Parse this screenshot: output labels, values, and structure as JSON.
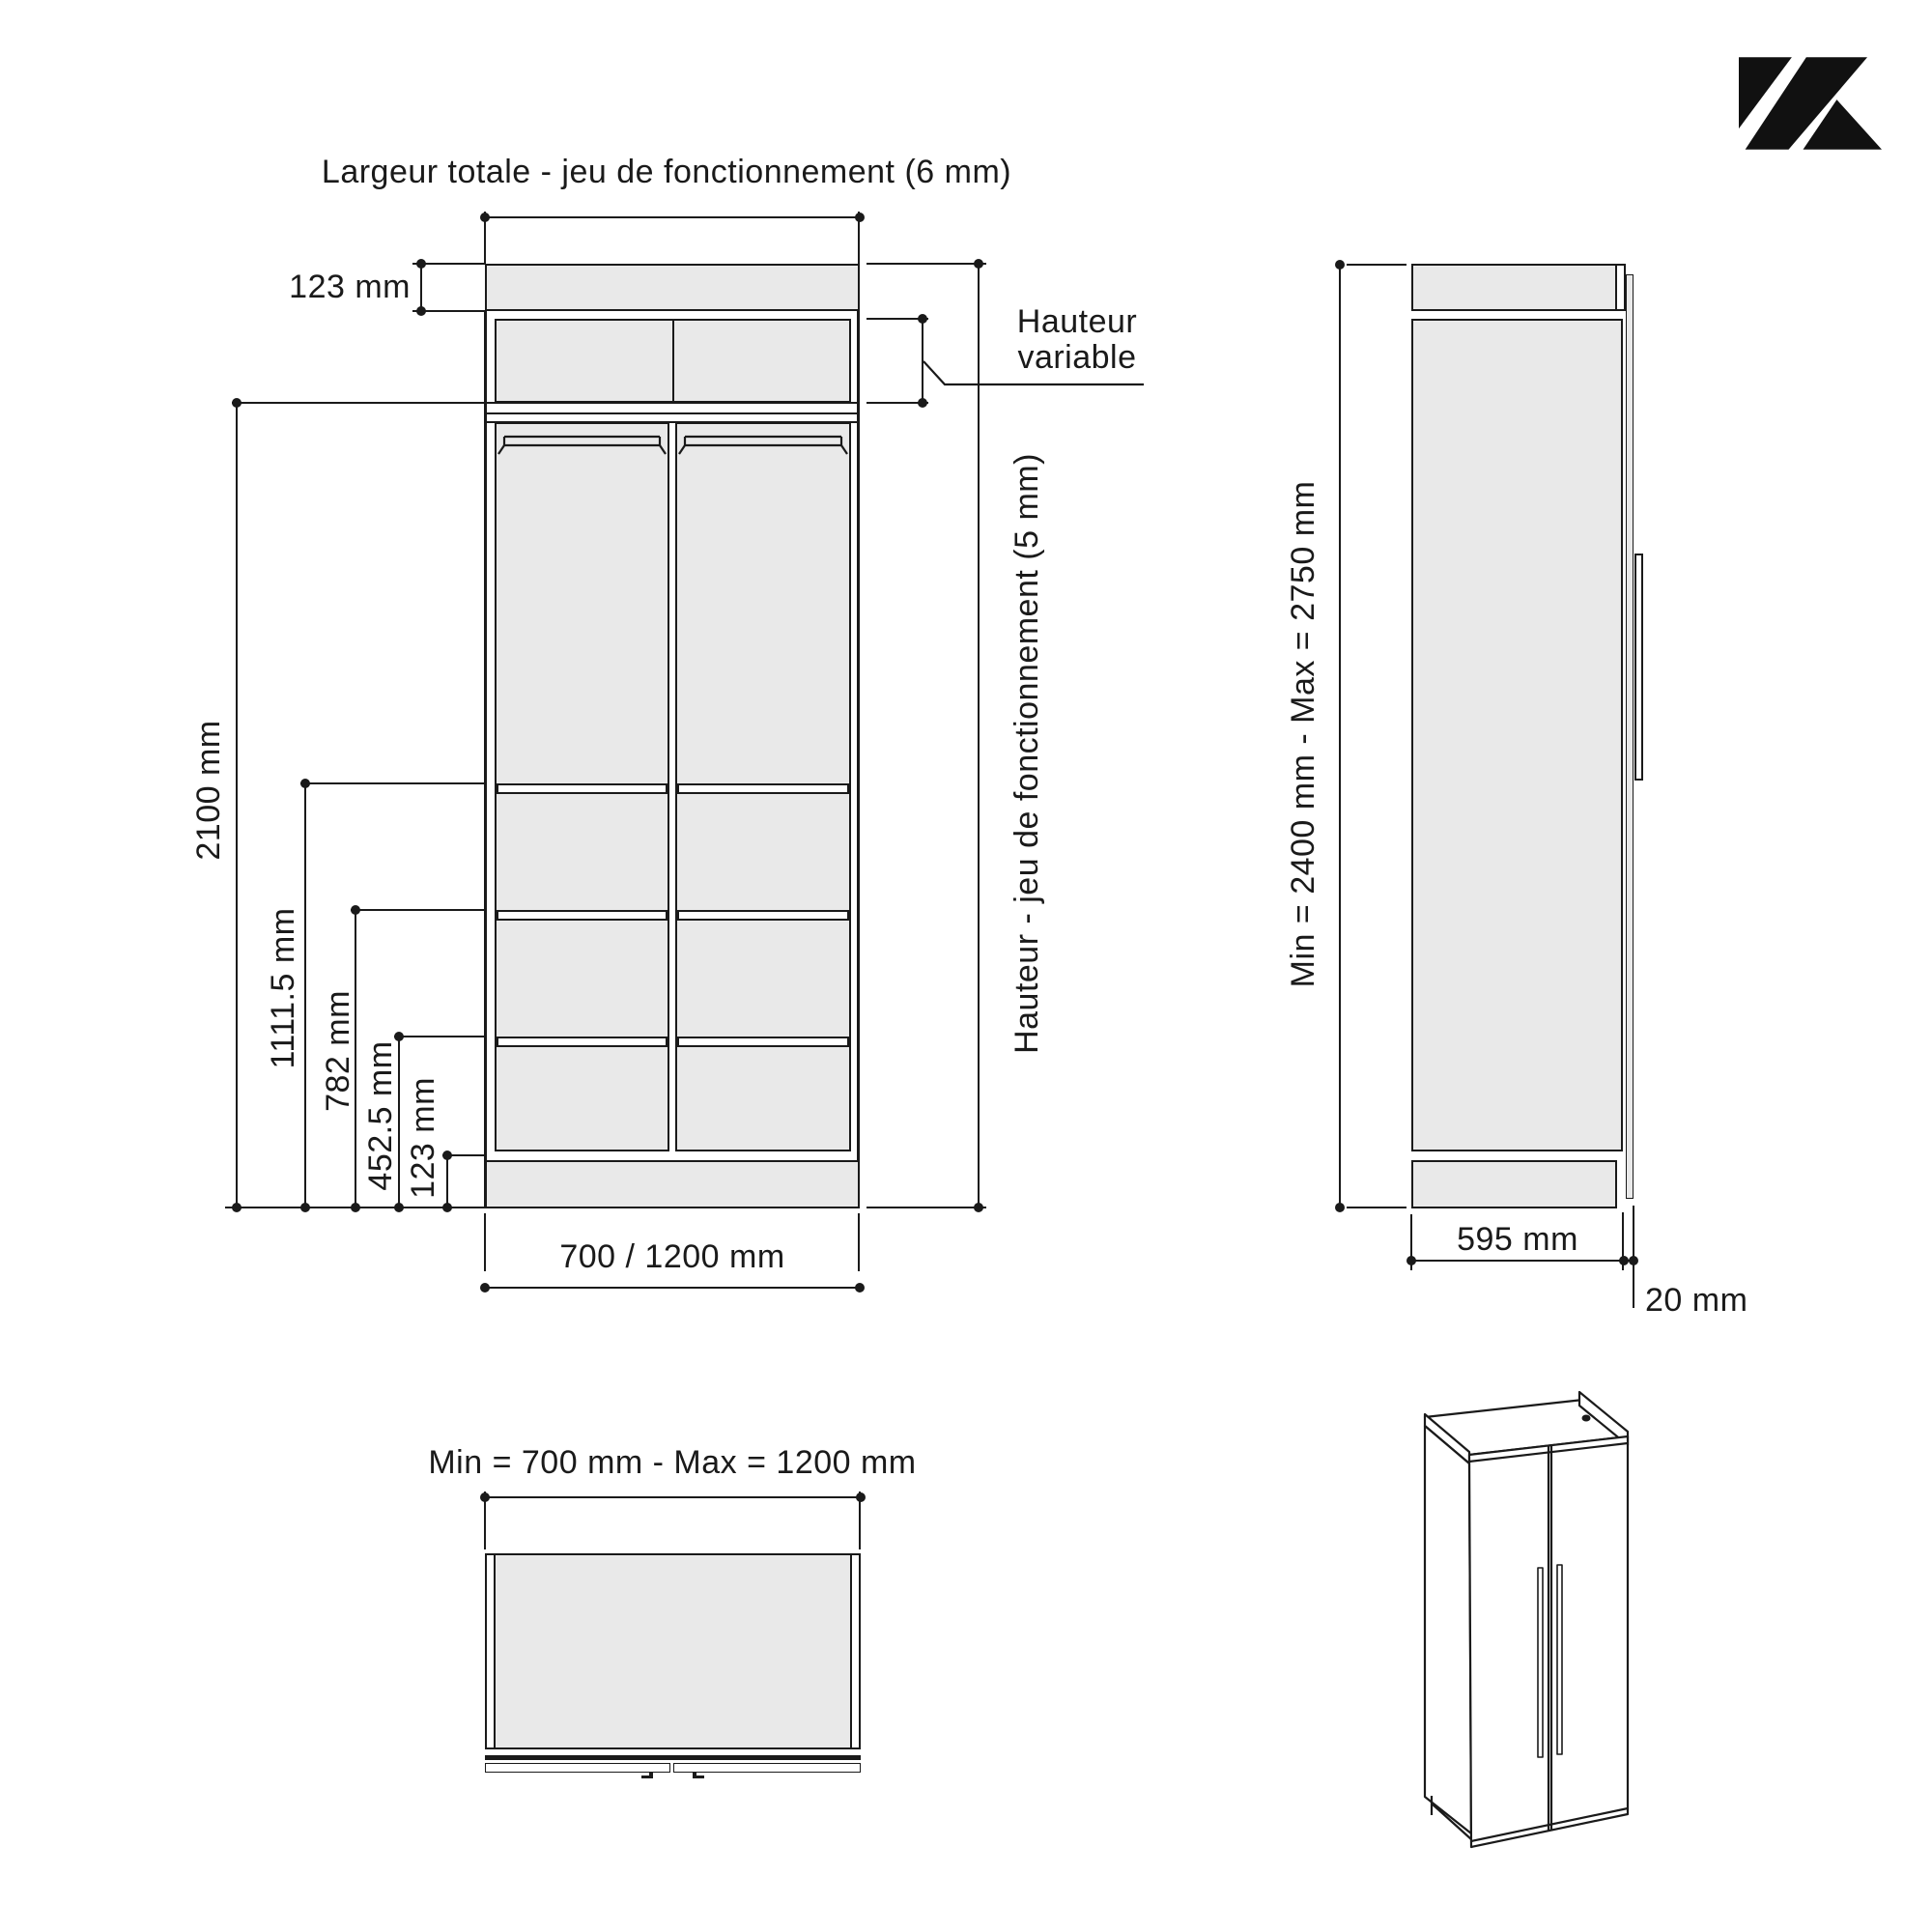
{
  "colors": {
    "line": "#1a1a1a",
    "panel_fill": "#e9e9e9",
    "background": "#ffffff",
    "logo": "#111111"
  },
  "front_view": {
    "title": "Largeur totale - jeu de fonctionnement (6 mm)",
    "top_band_dim": "123 mm",
    "height_dims": [
      "2100 mm",
      "1111.5 mm",
      "782 mm",
      "452.5 mm",
      "123 mm"
    ],
    "bottom_dim": "700 / 1200 mm",
    "variable_label_line1": "Hauteur",
    "variable_label_line2": "variable",
    "right_dim": "Hauteur - jeu de fonctionnement (5 mm)"
  },
  "side_view": {
    "height_dim": "Min = 2400 mm - Max = 2750 mm",
    "depth_dim": "595 mm",
    "door_dim": "20 mm"
  },
  "top_view": {
    "width_dim": "Min = 700 mm - Max = 1200 mm"
  }
}
